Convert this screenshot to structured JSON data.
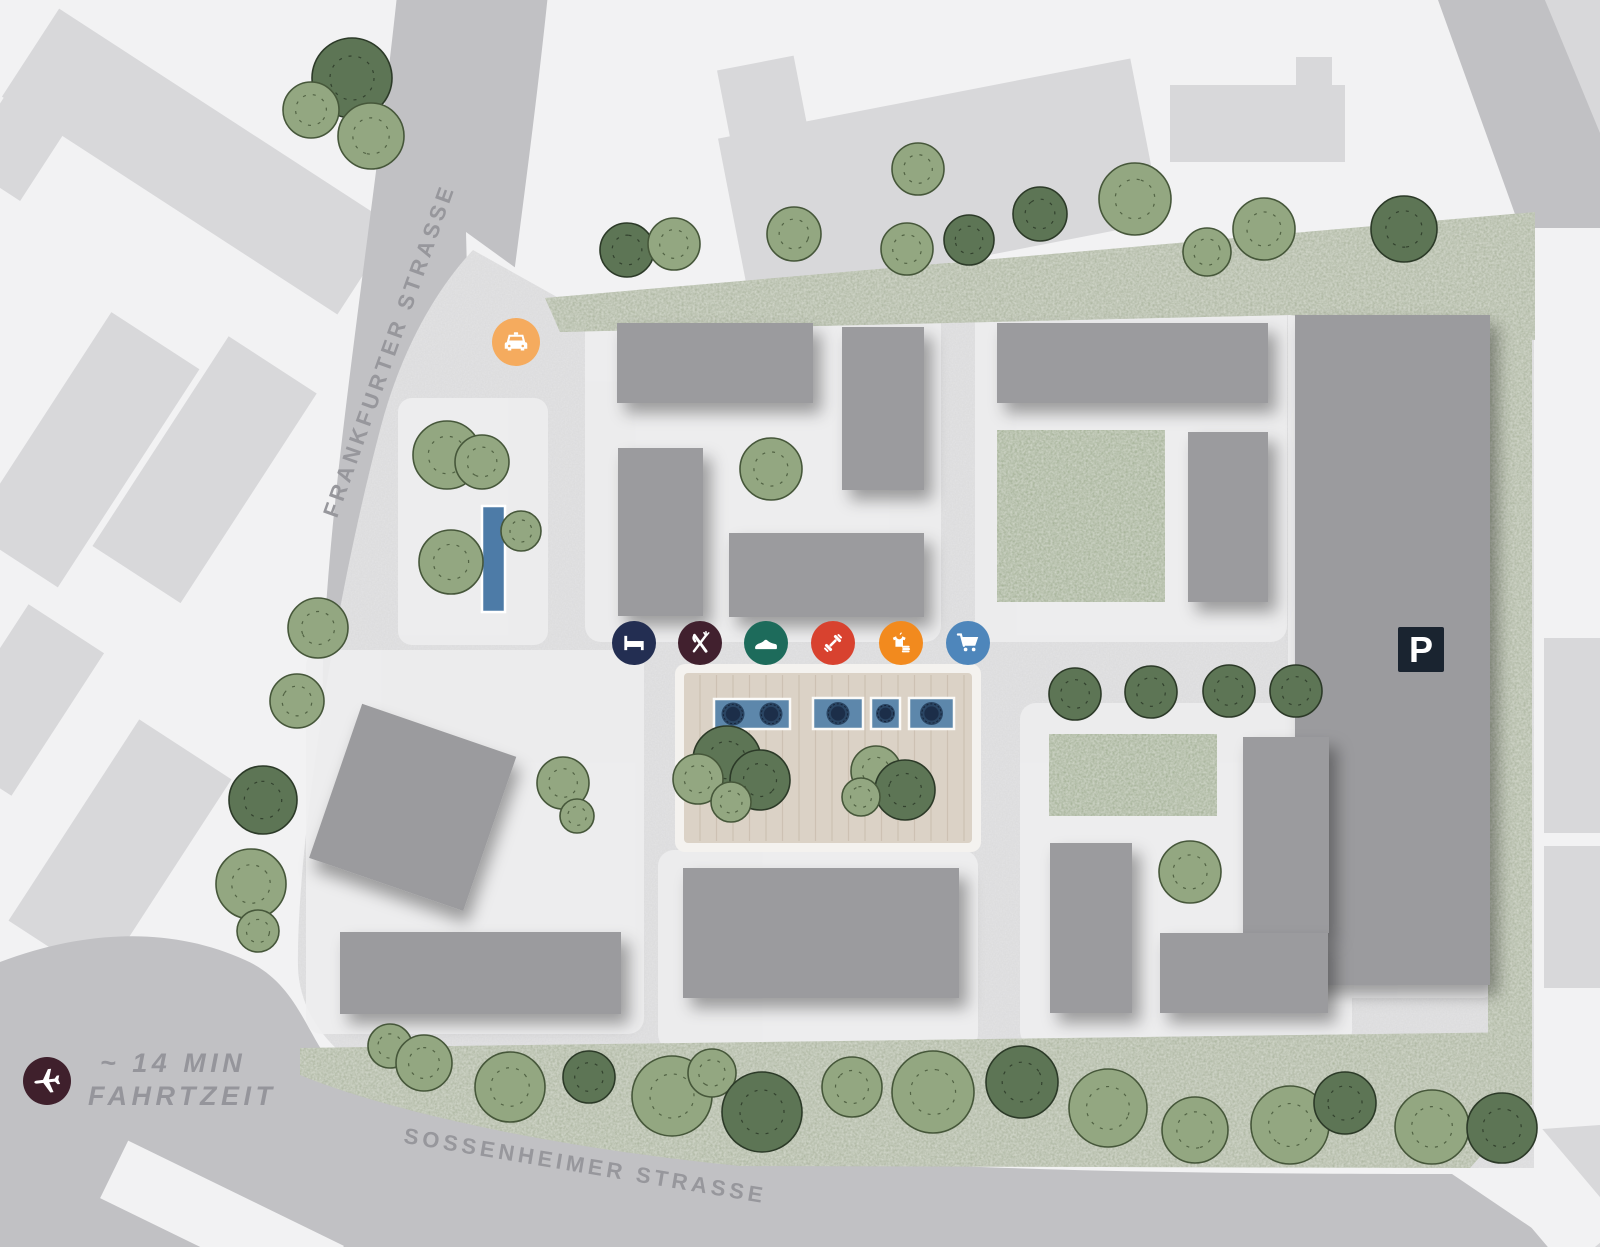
{
  "streets": {
    "frankfurter": "FRANKFURTER STRASSE",
    "sossenheimer": "SOSSENHEIMER STRASSE"
  },
  "airport_note": {
    "line1": "~ 14 MIN",
    "line2": "FAHRTZEIT",
    "icon": "airplane-icon",
    "circle_color": "#3f202c",
    "text_color": "#95959b"
  },
  "parking": {
    "label": "P",
    "sign_color": "#1a2430"
  },
  "poi_icons": {
    "taxi": {
      "name": "taxi-icon",
      "color": "#f5ab5e"
    },
    "hotel": {
      "name": "hotel-bed-icon",
      "color": "#232e52"
    },
    "restaurant": {
      "name": "restaurant-icon",
      "color": "#41202e"
    },
    "shoes": {
      "name": "shoe-store-icon",
      "color": "#1d6b5b"
    },
    "fitness": {
      "name": "fitness-icon",
      "color": "#d8422f"
    },
    "fashion": {
      "name": "fashion-store-icon",
      "color": "#f28a1e"
    },
    "supermarket": {
      "name": "supermarket-cart-icon",
      "color": "#4e86bb"
    }
  },
  "palette": {
    "background": "#f2f2f3",
    "road": "#c1c1c4",
    "context_building": "#d8d8da",
    "site_building": "#9b9b9e",
    "site_ground": "#e4e4e5",
    "plot": "#eeeeef",
    "grass": "#a6b099",
    "courtyard": "#9cab8e",
    "tree_light": "#93a781",
    "tree_dark": "#5d7555",
    "deck_wood": "#dbd2c6",
    "pool": "#5d87ab",
    "pool_basin": "#1c2e49",
    "marker_blue": "#4d7ba7"
  }
}
